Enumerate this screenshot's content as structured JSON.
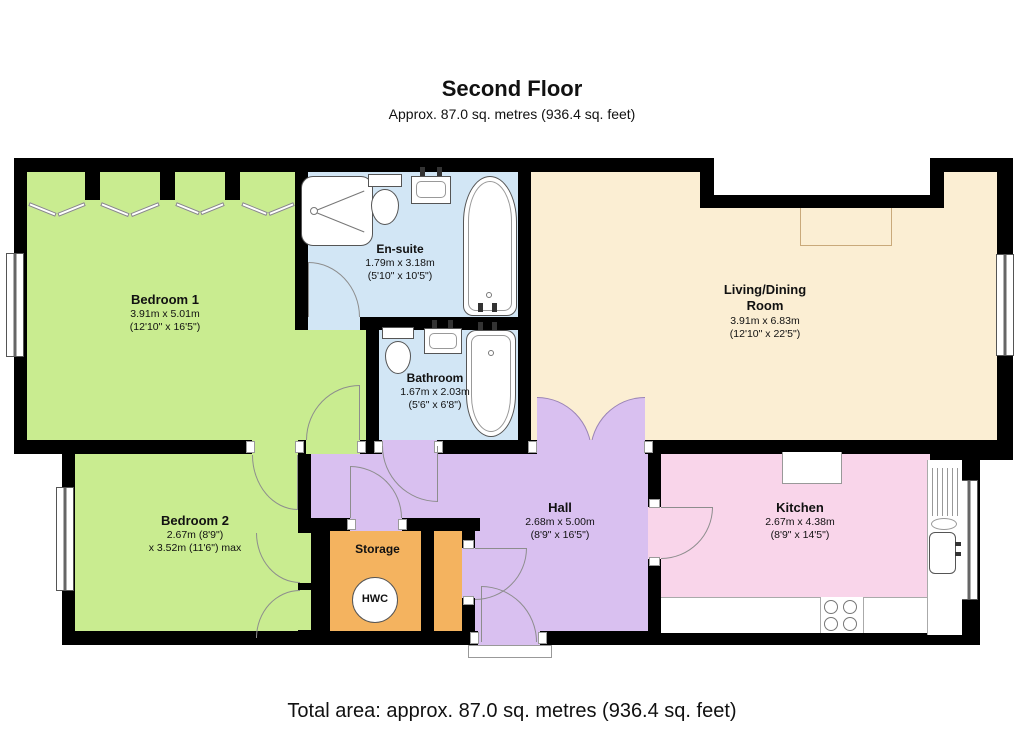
{
  "header": {
    "title": "Second Floor",
    "subtitle": "Approx. 87.0 sq. metres (936.4 sq. feet)"
  },
  "footer": {
    "total_area": "Total area: approx. 87.0 sq. metres (936.4 sq. feet)"
  },
  "rooms": [
    {
      "id": "bedroom1",
      "name": "Bedroom 1",
      "dims": [
        "3.91m x 5.01m",
        "(12'10\" x 16'5\")"
      ],
      "color": "#c9ec90"
    },
    {
      "id": "ensuite",
      "name": "En-suite",
      "dims": [
        "1.79m x 3.18m",
        "(5'10\" x 10'5\")"
      ],
      "color": "#d2e6f5"
    },
    {
      "id": "bathroom",
      "name": "Bathroom",
      "dims": [
        "1.67m x 2.03m",
        "(5'6\" x 6'8\")"
      ],
      "color": "#d2e6f5"
    },
    {
      "id": "living-dining",
      "name": "Living/Dining Room",
      "dims": [
        "3.91m x 6.83m",
        "(12'10\" x 22'5\")"
      ],
      "color": "#fbeed3"
    },
    {
      "id": "bedroom2",
      "name": "Bedroom 2",
      "dims": [
        "2.67m (8'9\")",
        "x 3.52m (11'6\") max"
      ],
      "color": "#c9ec90"
    },
    {
      "id": "hall",
      "name": "Hall",
      "dims": [
        "2.68m x 5.00m",
        "(8'9\" x 16'5\")"
      ],
      "color": "#d9c0f0"
    },
    {
      "id": "storage",
      "name": "Storage",
      "dims": [],
      "color": "#f4b35f"
    },
    {
      "id": "kitchen",
      "name": "Kitchen",
      "dims": [
        "2.67m x 4.38m",
        "(8'9\" x 14'5\")"
      ],
      "color": "#f9d5ea"
    }
  ],
  "labels": {
    "hwc": "HWC"
  },
  "colors": {
    "walls": "#000000",
    "exterior": "#ffffff",
    "fixture_outline": "#555555",
    "door_arc": "#8d8d8d"
  }
}
